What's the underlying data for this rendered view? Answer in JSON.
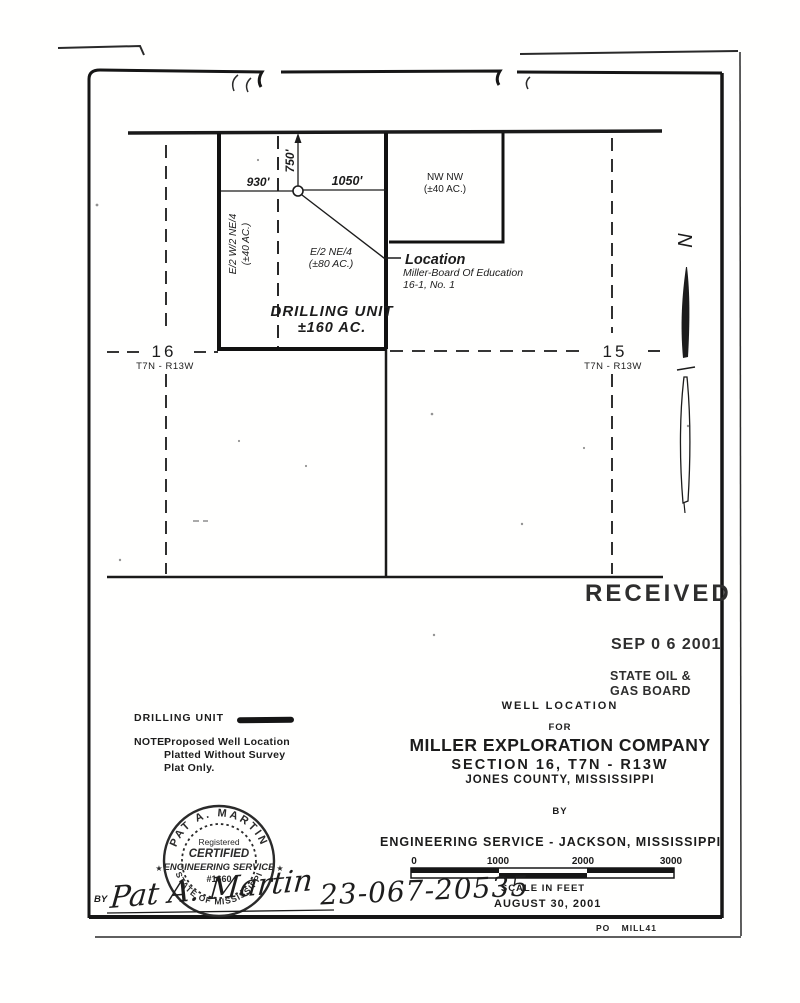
{
  "colors": {
    "ink": "#1c1c1c",
    "heavy_ink": "#111111",
    "stamp": "#2e2e2e",
    "paper": "#ffffff"
  },
  "stamp": {
    "received": "RECEIVED",
    "date": "SEP 0 6 2001",
    "board_line1": "STATE OIL &",
    "board_line2": "GAS BOARD"
  },
  "plat": {
    "section_16": {
      "number": "16",
      "township": "T7N - R13W"
    },
    "section_15": {
      "number": "15",
      "township": "T7N - R13W"
    },
    "dim_west": "930'",
    "dim_north": "750'",
    "dim_east": "1050'",
    "tract_w_line1": "E/2 W/2 NE/4",
    "tract_w_line2": "(±40 AC.)",
    "tract_c_line1": "E/2 NE/4",
    "tract_c_line2": "(±80 AC.)",
    "tract_ne_line1": "NW NW",
    "tract_ne_line2": "(±40 AC.)",
    "unit_line1": "DRILLING UNIT",
    "unit_line2": "±160 AC.",
    "loc_title": "Location",
    "loc_line1": "Miller-Board Of Education",
    "loc_line2": "16-1, No. 1",
    "north": "N"
  },
  "legend": {
    "unit_label": "DRILLING UNIT",
    "note_label": "NOTE:",
    "note_lines": [
      "Proposed Well Location",
      "Platted Without Survey",
      "Plat Only."
    ]
  },
  "title_block": {
    "heading": "WELL LOCATION",
    "for_word": "FOR",
    "company": "MILLER EXPLORATION COMPANY",
    "section_line": "SECTION 16, T7N - R13W",
    "county_line": "JONES COUNTY, MISSISSIPPI",
    "by_word": "BY",
    "firm_line": "ENGINEERING SERVICE - JACKSON, MISSISSIPPI",
    "date": "AUGUST 30, 2001"
  },
  "scale_bar": {
    "ticks": [
      "0",
      "1000",
      "2000",
      "3000"
    ],
    "caption": "SCALE IN FEET"
  },
  "seal": {
    "arc_top": "PAT A. MARTIN",
    "arc_bottom": "STATE OF MISSISSIPPI",
    "line1": "Registered",
    "line2": "CERTIFIED",
    "line3": "ENGINEERING SERVICE",
    "line4": "#1660",
    "star": "★"
  },
  "signature": {
    "by_label": "BY",
    "name": "Pat A. Martin"
  },
  "handwritten": {
    "permit_number": "23-067-20535"
  },
  "footer": {
    "code": "PO MILL41"
  }
}
